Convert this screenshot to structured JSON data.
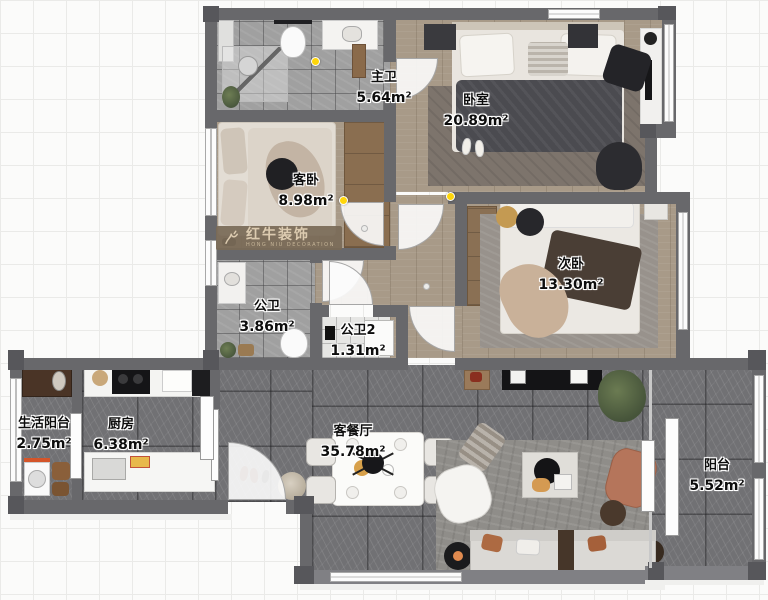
{
  "watermark": {
    "brand": "红牛装饰",
    "tagline": "HONG NIU DECORATION"
  },
  "rooms": [
    {
      "id": "master-bath",
      "name": "主卫",
      "area": "5.64m²"
    },
    {
      "id": "master-bedroom",
      "name": "卧室",
      "area": "20.89m²"
    },
    {
      "id": "guest-bedroom",
      "name": "客卧",
      "area": "8.98m²"
    },
    {
      "id": "second-bedroom",
      "name": "次卧",
      "area": "13.30m²"
    },
    {
      "id": "public-bath",
      "name": "公卫",
      "area": "3.86m²"
    },
    {
      "id": "public-bath-2",
      "name": "公卫2",
      "area": "1.31m²"
    },
    {
      "id": "laundry-balcony",
      "name": "生活阳台",
      "area": "2.75m²"
    },
    {
      "id": "kitchen",
      "name": "厨房",
      "area": "6.38m²"
    },
    {
      "id": "living-dining",
      "name": "客餐厅",
      "area": "35.78m²"
    },
    {
      "id": "balcony",
      "name": "阳台",
      "area": "5.52m²"
    }
  ],
  "colors": {
    "wall": "#68686b",
    "wood_floor": "#a89a88",
    "gray_tile": "#a0a0a0",
    "dark_tile": "#717174",
    "white_tile": "#e6e6e4",
    "marker_yellow": "#ffd60a",
    "watermark_bg": "#7a6a57",
    "watermark_text": "#dccbb0"
  }
}
